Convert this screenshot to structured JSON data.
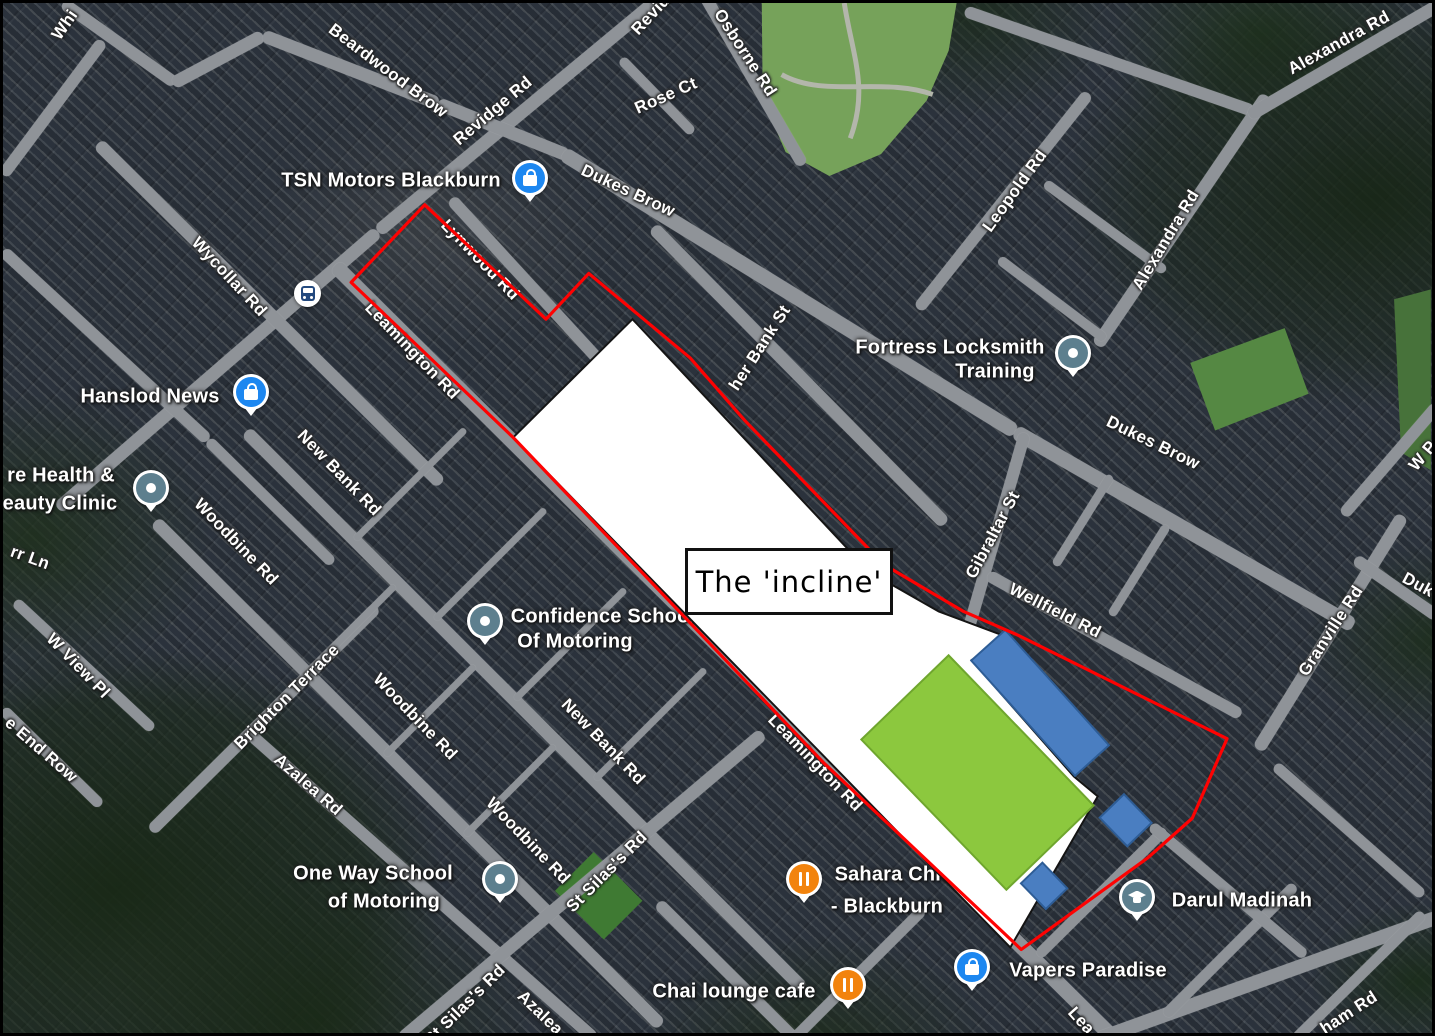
{
  "frame": {
    "width": 1435,
    "height": 1036,
    "border_color": "#000000"
  },
  "map": {
    "imagery": "satellite",
    "base_color": "#333b45",
    "road_color": "#8f9398",
    "ground": {
      "park": {
        "points": "762,0 958,0 950,48 928,98 882,152 830,174 786,150 763,96",
        "fill": "#76a25a"
      },
      "park_paths": [
        {
          "d": "M 845,0 C 853,52 870,86 851,136",
          "stroke": "#b3b6ab"
        },
        {
          "d": "M 782,72 C 824,96 884,74 934,92",
          "stroke": "#b3b6ab"
        }
      ],
      "polys": [
        {
          "name": "sports-pitch",
          "points": "1193,362 1288,327 1312,393 1218,430",
          "fill": "#558843"
        },
        {
          "name": "grass-right",
          "points": "1398,298 1435,288 1435,470 1405,452",
          "fill": "#47723a"
        },
        {
          "name": "school-pitch",
          "points": "642,903 603,942 554,893 593,854",
          "fill": "#3f7a33"
        }
      ]
    },
    "roads": [
      {
        "x1": 55,
        "y1": 505,
        "x2": 375,
        "y2": 228,
        "w": 13
      },
      {
        "x1": 375,
        "y1": 228,
        "x2": 668,
        "y2": -15,
        "w": 13
      },
      {
        "x1": 60,
        "y1": 0,
        "x2": 172,
        "y2": 80,
        "w": 12
      },
      {
        "x1": 170,
        "y1": 80,
        "x2": 260,
        "y2": 32,
        "w": 13
      },
      {
        "x1": 260,
        "y1": 32,
        "x2": 435,
        "y2": 100,
        "w": 13
      },
      {
        "x1": 435,
        "y1": 100,
        "x2": 565,
        "y2": 152,
        "w": 13
      },
      {
        "x1": 0,
        "y1": 172,
        "x2": 100,
        "y2": 38,
        "w": 12
      },
      {
        "x1": 0,
        "y1": 248,
        "x2": 205,
        "y2": 437,
        "w": 12
      },
      {
        "x1": 205,
        "y1": 437,
        "x2": 330,
        "y2": 560,
        "w": 11
      },
      {
        "x1": 95,
        "y1": 140,
        "x2": 438,
        "y2": 480,
        "w": 13
      },
      {
        "x1": 560,
        "y1": 150,
        "x2": 1012,
        "y2": 428,
        "w": 15
      },
      {
        "x1": 1012,
        "y1": 428,
        "x2": 1350,
        "y2": 622,
        "w": 15
      },
      {
        "x1": 448,
        "y1": 196,
        "x2": 706,
        "y2": 477,
        "w": 12
      },
      {
        "x1": 332,
        "y1": 262,
        "x2": 1112,
        "y2": 1036,
        "w": 15
      },
      {
        "x1": 650,
        "y1": 224,
        "x2": 942,
        "y2": 520,
        "w": 13
      },
      {
        "x1": 958,
        "y1": 652,
        "x2": 1022,
        "y2": 430,
        "w": 12
      },
      {
        "x1": 985,
        "y1": 572,
        "x2": 1238,
        "y2": 712,
        "w": 12
      },
      {
        "x1": 243,
        "y1": 428,
        "x2": 800,
        "y2": 985,
        "w": 13
      },
      {
        "x1": 152,
        "y1": 518,
        "x2": 658,
        "y2": 1022,
        "w": 13
      },
      {
        "x1": 248,
        "y1": 732,
        "x2": 592,
        "y2": 1036,
        "w": 12
      },
      {
        "x1": 148,
        "y1": 828,
        "x2": 374,
        "y2": 604,
        "w": 12
      },
      {
        "x1": 12,
        "y1": 598,
        "x2": 150,
        "y2": 726,
        "w": 11
      },
      {
        "x1": 0,
        "y1": 706,
        "x2": 98,
        "y2": 802,
        "w": 11
      },
      {
        "x1": 398,
        "y1": 1036,
        "x2": 760,
        "y2": 730,
        "w": 13
      },
      {
        "x1": 700,
        "y1": -10,
        "x2": 800,
        "y2": 162,
        "w": 12
      },
      {
        "x1": 618,
        "y1": 56,
        "x2": 690,
        "y2": 130,
        "w": 10
      },
      {
        "x1": 962,
        "y1": 8,
        "x2": 1250,
        "y2": 108,
        "w": 12
      },
      {
        "x1": 915,
        "y1": 306,
        "x2": 1086,
        "y2": 90,
        "w": 12
      },
      {
        "x1": 1094,
        "y1": 342,
        "x2": 1264,
        "y2": 92,
        "w": 13
      },
      {
        "x1": 1246,
        "y1": 112,
        "x2": 1435,
        "y2": 2,
        "w": 13
      },
      {
        "x1": 996,
        "y1": 256,
        "x2": 1102,
        "y2": 336,
        "w": 10
      },
      {
        "x1": 1042,
        "y1": 180,
        "x2": 1162,
        "y2": 268,
        "w": 10
      },
      {
        "x1": 1255,
        "y1": 746,
        "x2": 1400,
        "y2": 512,
        "w": 13
      },
      {
        "x1": 1340,
        "y1": 512,
        "x2": 1435,
        "y2": 402,
        "w": 12
      },
      {
        "x1": 1352,
        "y1": 556,
        "x2": 1435,
        "y2": 614,
        "w": 12
      },
      {
        "x1": 1095,
        "y1": 1036,
        "x2": 1435,
        "y2": 914,
        "w": 14
      },
      {
        "x1": 1035,
        "y1": 952,
        "x2": 1162,
        "y2": 826,
        "w": 11
      },
      {
        "x1": 1162,
        "y1": 1012,
        "x2": 1292,
        "y2": 882,
        "w": 11
      },
      {
        "x1": 1292,
        "y1": 1036,
        "x2": 1420,
        "y2": 910,
        "w": 11
      },
      {
        "x1": 1148,
        "y1": 822,
        "x2": 1302,
        "y2": 952,
        "w": 11
      },
      {
        "x1": 1272,
        "y1": 762,
        "x2": 1420,
        "y2": 892,
        "w": 11
      },
      {
        "x1": 655,
        "y1": 900,
        "x2": 792,
        "y2": 1036,
        "w": 12
      },
      {
        "x1": 790,
        "y1": 1036,
        "x2": 920,
        "y2": 906,
        "w": 11
      },
      {
        "x1": 1052,
        "y1": 562,
        "x2": 1108,
        "y2": 472,
        "w": 9
      },
      {
        "x1": 1108,
        "y1": 612,
        "x2": 1164,
        "y2": 522,
        "w": 9
      },
      {
        "x1": 352,
        "y1": 536,
        "x2": 462,
        "y2": 426,
        "w": 7
      },
      {
        "x1": 432,
        "y1": 616,
        "x2": 542,
        "y2": 506,
        "w": 7
      },
      {
        "x1": 512,
        "y1": 696,
        "x2": 622,
        "y2": 586,
        "w": 7
      },
      {
        "x1": 592,
        "y1": 776,
        "x2": 702,
        "y2": 666,
        "w": 7
      },
      {
        "x1": 302,
        "y1": 672,
        "x2": 392,
        "y2": 582,
        "w": 7
      },
      {
        "x1": 382,
        "y1": 752,
        "x2": 472,
        "y2": 662,
        "w": 7
      },
      {
        "x1": 462,
        "y1": 832,
        "x2": 552,
        "y2": 742,
        "w": 7
      }
    ],
    "road_labels": [
      {
        "text": "Whi",
        "x": 62,
        "y": 22,
        "rot": -55,
        "size": 17
      },
      {
        "text": "Beardwood Brow",
        "x": 385,
        "y": 68,
        "rot": 37,
        "size": 17
      },
      {
        "text": "Revidge Rd",
        "x": 490,
        "y": 108,
        "rot": -40,
        "size": 17
      },
      {
        "text": "Revid",
        "x": 648,
        "y": 12,
        "rot": -47,
        "size": 17
      },
      {
        "text": "Osborne Rd",
        "x": 742,
        "y": 50,
        "rot": 57,
        "size": 17
      },
      {
        "text": "Rose Ct",
        "x": 663,
        "y": 93,
        "rot": -24,
        "size": 17
      },
      {
        "text": "Dukes Brow",
        "x": 625,
        "y": 188,
        "rot": 25,
        "size": 17
      },
      {
        "text": "Alexandra Rd",
        "x": 1336,
        "y": 40,
        "rot": -29,
        "size": 17
      },
      {
        "text": "Leopold Rd",
        "x": 1012,
        "y": 188,
        "rot": -54,
        "size": 17
      },
      {
        "text": "Alexandra Rd",
        "x": 1163,
        "y": 237,
        "rot": -59,
        "size": 17
      },
      {
        "text": "Wycollar Rd",
        "x": 226,
        "y": 274,
        "rot": 47,
        "size": 17
      },
      {
        "text": "Lynwood Rd",
        "x": 477,
        "y": 257,
        "rot": 46,
        "size": 17
      },
      {
        "text": "Leamington Rd",
        "x": 409,
        "y": 348,
        "rot": 46,
        "size": 17
      },
      {
        "text": "her Bank St",
        "x": 757,
        "y": 345,
        "rot": -57,
        "size": 17
      },
      {
        "text": "New Bank Rd",
        "x": 336,
        "y": 470,
        "rot": 46,
        "size": 17
      },
      {
        "text": "Dukes Brow",
        "x": 1150,
        "y": 440,
        "rot": 26,
        "size": 17
      },
      {
        "text": "W P",
        "x": 1420,
        "y": 453,
        "rot": -50,
        "size": 17
      },
      {
        "text": "Woodbine Rd",
        "x": 233,
        "y": 539,
        "rot": 46,
        "size": 17
      },
      {
        "text": "Gibraltar St",
        "x": 990,
        "y": 532,
        "rot": -62,
        "size": 17
      },
      {
        "text": "rr Ln",
        "x": 27,
        "y": 555,
        "rot": 20,
        "size": 17
      },
      {
        "text": "Wellfield Rd",
        "x": 1052,
        "y": 608,
        "rot": 27,
        "size": 17
      },
      {
        "text": "Granville Rd",
        "x": 1328,
        "y": 628,
        "rot": -57,
        "size": 17
      },
      {
        "text": "Duk",
        "x": 1415,
        "y": 582,
        "rot": 28,
        "size": 17
      },
      {
        "text": "W View Pl",
        "x": 75,
        "y": 663,
        "rot": 46,
        "size": 17
      },
      {
        "text": "Brighton Terrace",
        "x": 284,
        "y": 694,
        "rot": -45,
        "size": 17
      },
      {
        "text": "Woodbine Rd",
        "x": 412,
        "y": 714,
        "rot": 46,
        "size": 17
      },
      {
        "text": "e End Row",
        "x": 38,
        "y": 747,
        "rot": 41,
        "size": 17
      },
      {
        "text": "Leamington Rd",
        "x": 812,
        "y": 760,
        "rot": 46,
        "size": 17
      },
      {
        "text": "New Bank Rd",
        "x": 600,
        "y": 739,
        "rot": 46,
        "size": 17
      },
      {
        "text": "Azalea Rd",
        "x": 305,
        "y": 782,
        "rot": 41,
        "size": 17
      },
      {
        "text": "Woodbine Rd",
        "x": 525,
        "y": 838,
        "rot": 46,
        "size": 17
      },
      {
        "text": "St Silas's Rd",
        "x": 604,
        "y": 869,
        "rot": -45,
        "size": 17
      },
      {
        "text": "St Silas's Rd",
        "x": 462,
        "y": 1002,
        "rot": -45,
        "size": 17
      },
      {
        "text": "Azalea",
        "x": 537,
        "y": 1010,
        "rot": 44,
        "size": 17
      },
      {
        "text": "Lea",
        "x": 1078,
        "y": 1018,
        "rot": 48,
        "size": 17
      },
      {
        "text": "ham Rd",
        "x": 1346,
        "y": 1010,
        "rot": -33,
        "size": 17
      }
    ],
    "pois": [
      {
        "type": "shopping",
        "icon": "shopping-bag-icon",
        "px": 527,
        "py": 178,
        "lines": [
          {
            "text": "TSN Motors Blackburn",
            "x": 388,
            "y": 178
          }
        ]
      },
      {
        "type": "shopping",
        "icon": "shopping-bag-icon",
        "px": 248,
        "py": 392,
        "lines": [
          {
            "text": "Hanslod News",
            "x": 147,
            "y": 394
          }
        ]
      },
      {
        "type": "place",
        "icon": "place-dot-icon",
        "px": 148,
        "py": 488,
        "lines": [
          {
            "text": "re Health &",
            "x": 58,
            "y": 473
          },
          {
            "text": "eauty Clinic",
            "x": 57,
            "y": 501
          }
        ]
      },
      {
        "type": "place",
        "icon": "place-dot-icon",
        "px": 1070,
        "py": 353,
        "lines": [
          {
            "text": "Fortress Locksmith",
            "x": 947,
            "y": 345
          },
          {
            "text": "Training",
            "x": 992,
            "y": 369
          }
        ]
      },
      {
        "type": "place",
        "icon": "place-dot-icon",
        "px": 482,
        "py": 621,
        "lines": [
          {
            "text": "Confidence School",
            "x": 600,
            "y": 614
          },
          {
            "text": "Of Motoring",
            "x": 572,
            "y": 639
          }
        ]
      },
      {
        "type": "place",
        "icon": "place-dot-icon",
        "px": 497,
        "py": 879,
        "lines": [
          {
            "text": "One Way School",
            "x": 370,
            "y": 871
          },
          {
            "text": "of Motoring",
            "x": 381,
            "y": 899
          }
        ]
      },
      {
        "type": "restaurant",
        "icon": "restaurant-icon",
        "px": 801,
        "py": 879,
        "lines": [
          {
            "text": "Sahara Chicken",
            "x": 908,
            "y": 872
          },
          {
            "text": "- Blackburn",
            "x": 884,
            "y": 904
          }
        ]
      },
      {
        "type": "restaurant",
        "icon": "restaurant-icon",
        "px": 845,
        "py": 985,
        "lines": [
          {
            "text": "Chai lounge cafe",
            "x": 731,
            "y": 989
          }
        ]
      },
      {
        "type": "shopping",
        "icon": "shopping-bag-icon",
        "px": 969,
        "py": 967,
        "lines": [
          {
            "text": "Vapers Paradise",
            "x": 1085,
            "y": 968
          }
        ]
      },
      {
        "type": "school",
        "icon": "graduation-cap-icon",
        "px": 1134,
        "py": 897,
        "lines": [
          {
            "text": "Darul Madinah",
            "x": 1239,
            "y": 898
          }
        ]
      },
      {
        "type": "bus",
        "icon": "bus-stop-icon",
        "px": 305,
        "py": 291,
        "lines": []
      }
    ]
  },
  "annotation": {
    "incline_label": "The 'incline'",
    "incline_box": {
      "x": 682,
      "y": 545,
      "w": 208,
      "h": 67
    },
    "white_fill": "#ffffff",
    "white_stroke": "#141414",
    "white_area_points": "632,318 870,572 940,612 1007,637 973,661 1076,778 1100,798 1012,950 512,437",
    "red_color": "#fe0202",
    "red_boundary_points": "423,203 545,318 588,272 690,357 745,420 885,565 965,612 1020,636 1230,740 1195,820 1150,860 1023,952 825,765 512,437 349,281",
    "green_rect": {
      "cx": 979,
      "cy": 774,
      "w": 210,
      "h": 122,
      "rot": 46,
      "fill": "#8cc83e",
      "stroke": "#6fa62e"
    },
    "blue_rects": [
      {
        "cx": 1042,
        "cy": 704,
        "w": 156,
        "h": 46,
        "rot": 48,
        "fill": "#4a7ec1",
        "stroke": "#2e5d96"
      },
      {
        "cx": 1128,
        "cy": 822,
        "w": 40,
        "h": 34,
        "rot": 46,
        "fill": "#4a7ec1",
        "stroke": "#2e5d96"
      },
      {
        "cx": 1046,
        "cy": 888,
        "w": 36,
        "h": 30,
        "rot": 46,
        "fill": "#4a7ec1",
        "stroke": "#2e5d96"
      }
    ]
  }
}
